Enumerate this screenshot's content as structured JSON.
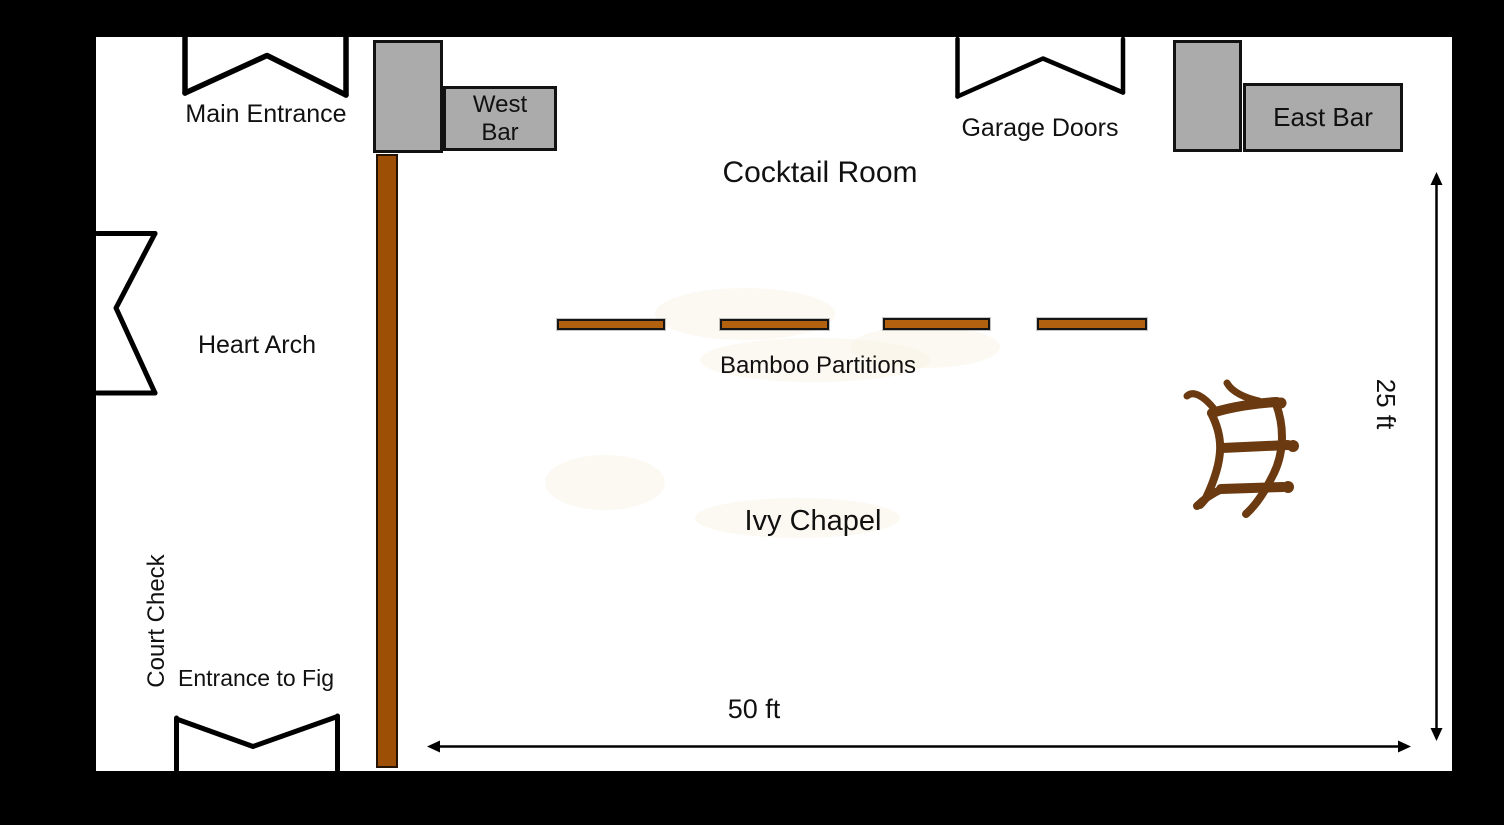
{
  "diagram": {
    "type": "venue-floor-plan",
    "rooms": {
      "cocktail_room": "Cocktail Room",
      "ivy_chapel": "Ivy Chapel"
    },
    "features": {
      "main_entrance": "Main Entrance",
      "west_bar": {
        "line1": "West",
        "line2": "Bar"
      },
      "garage_doors": "Garage Doors",
      "east_bar": "East Bar",
      "heart_arch": "Heart Arch",
      "bamboo_partitions": "Bamboo Partitions",
      "court_check": "Court Check",
      "entrance_to_fig": "Entrance to Fig"
    },
    "dimensions": {
      "width": "50 ft",
      "height": "25 ft"
    },
    "icons": {
      "main_entrance_door": "double-door-swing-icon",
      "garage_doors": "double-door-swing-icon",
      "heart_arch_door": "side-door-swing-icon",
      "fig_entrance_door": "double-door-swing-icon",
      "wedding_arch_sketch": "hand-drawn-arch-icon",
      "width_arrow": "horizontal-double-arrow-icon",
      "height_arrow": "vertical-double-arrow-icon"
    },
    "colors": {
      "background": "#000000",
      "floor": "#ffffff",
      "bar_fill": "#ababab",
      "outline": "#121212",
      "bamboo_fill": "#b2620f",
      "partition_wall_fill": "#9d4f06",
      "sketch_brown": "#6b3a10"
    }
  }
}
